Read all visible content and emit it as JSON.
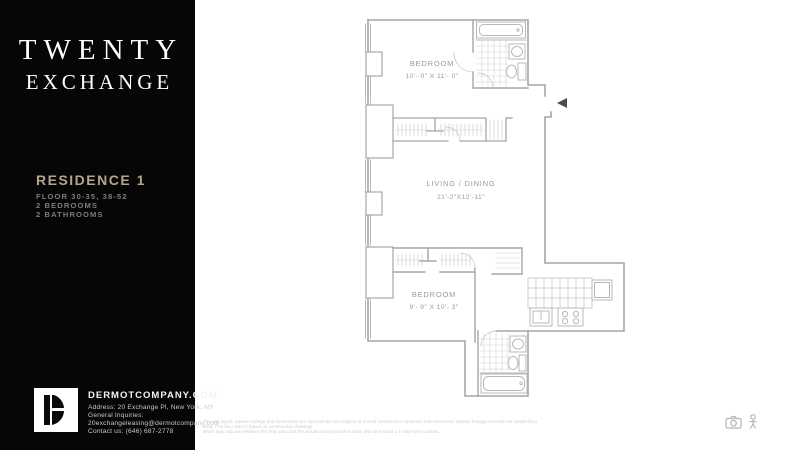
{
  "sidebar": {
    "background_color": "#060606",
    "brand": {
      "line1": "TWENTY",
      "line2": "EXCHANGE"
    },
    "residence": {
      "title": "RESIDENCE 1",
      "title_color": "#b5a68b",
      "floors": "FLOOR 30-35, 38-52",
      "bedrooms": "2 BEDROOMS",
      "bathrooms": "2 BATHROOMS"
    },
    "footer": {
      "website": "DERMOTCOMPANY.COM",
      "address": "Address: 20 Exchange Pl, New York, NY",
      "inquiries_label": "General Inquiries:",
      "email": "20exchangeleasing@dermotcompany.com",
      "contact": "Contact us: (646) 687-2778"
    }
  },
  "floorplan": {
    "wall_color": "#a6a6a6",
    "fixture_color": "#b8b8b8",
    "label_color": "#9a9a9a",
    "entry_marker_color": "#4d4d4d",
    "rooms": {
      "bedroom1": {
        "name": "BEDROOM",
        "dimensions": "10'- 0\" X 11'- 0\""
      },
      "living": {
        "name": "LIVING / DINING",
        "dimensions": "21'-2\"X12'-11\""
      },
      "bedroom2": {
        "name": "BEDROOM",
        "dimensions": "9'- 9\" X 10'- 3\""
      }
    }
  },
  "disclaimer": {
    "line1": "The unit layout, square footage and dimensions are approximate and subject to normal construction variances and tolerances. Square footage exceeds the usable floor area. This floor plan is based on construction drawings",
    "line2": "which may indicate between this floor plan and the actual unit layout when built, will not exceed a 1-step from contract."
  }
}
